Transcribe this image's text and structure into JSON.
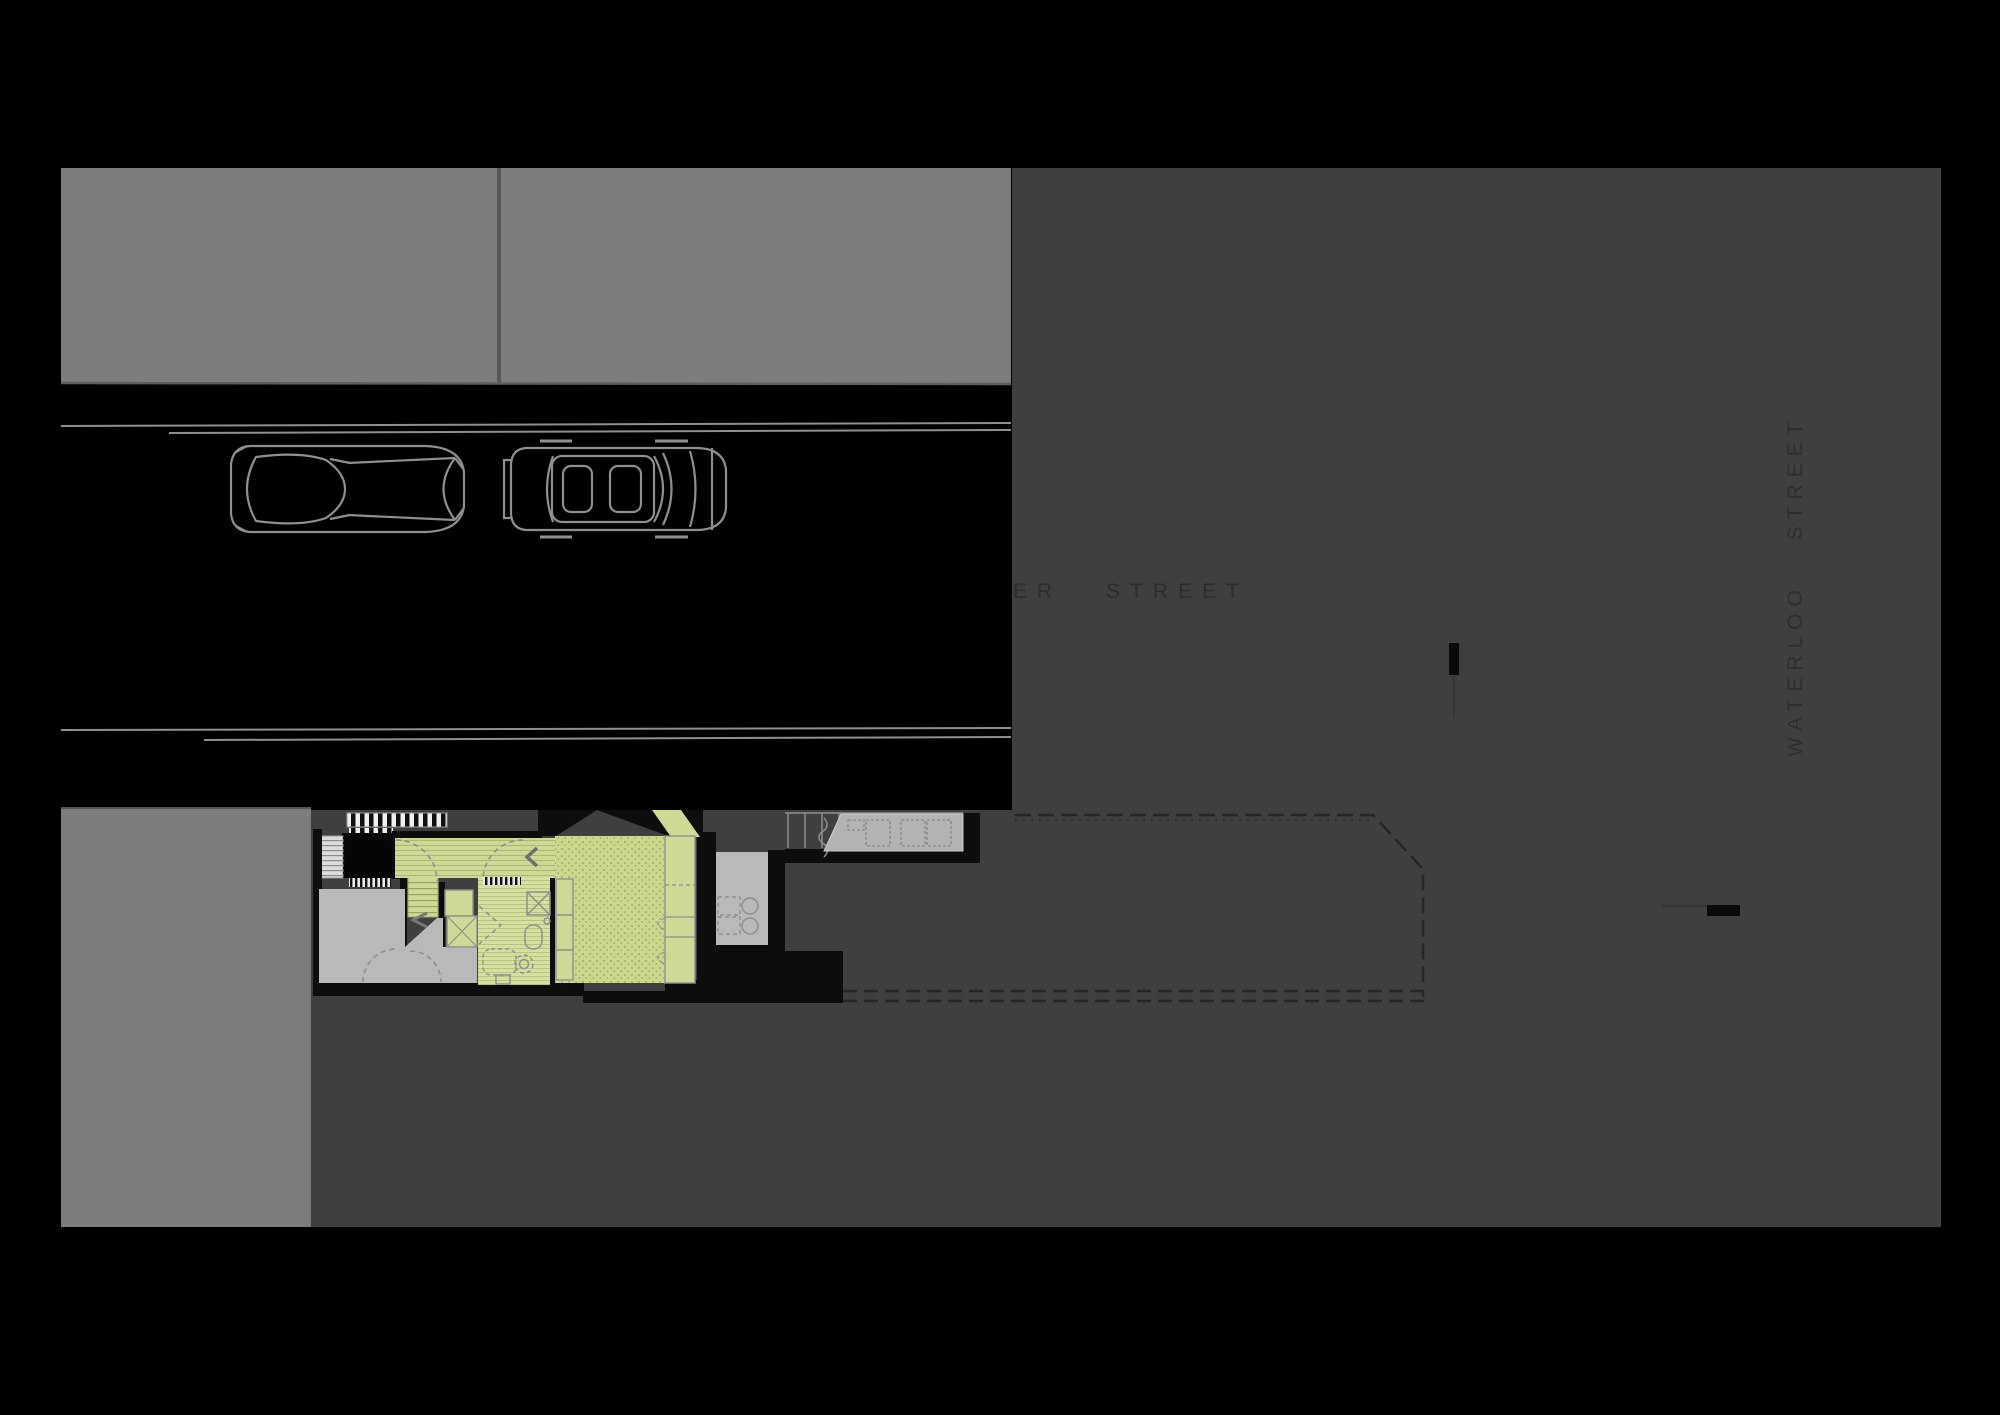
{
  "canvas": {
    "width": 2000,
    "height": 1415
  },
  "streets": {
    "cross_street": "ER STREET",
    "side_street": "WATERLOO STREET",
    "parked_cars": 2
  },
  "colors": {
    "background": "#000000",
    "street_asphalt": "#000000",
    "building_mass_gray": "#7d7d7d",
    "neighbour_block_gray": "#3f3f3f",
    "interior_room_gray": "#b9b9b9",
    "deck_gray": "#b3b3b3",
    "floor_green": "#cfd996",
    "outline_gray": "#8f8f8f",
    "wall_black": "#0d0d0d",
    "street_text": "#2c2c2c"
  }
}
